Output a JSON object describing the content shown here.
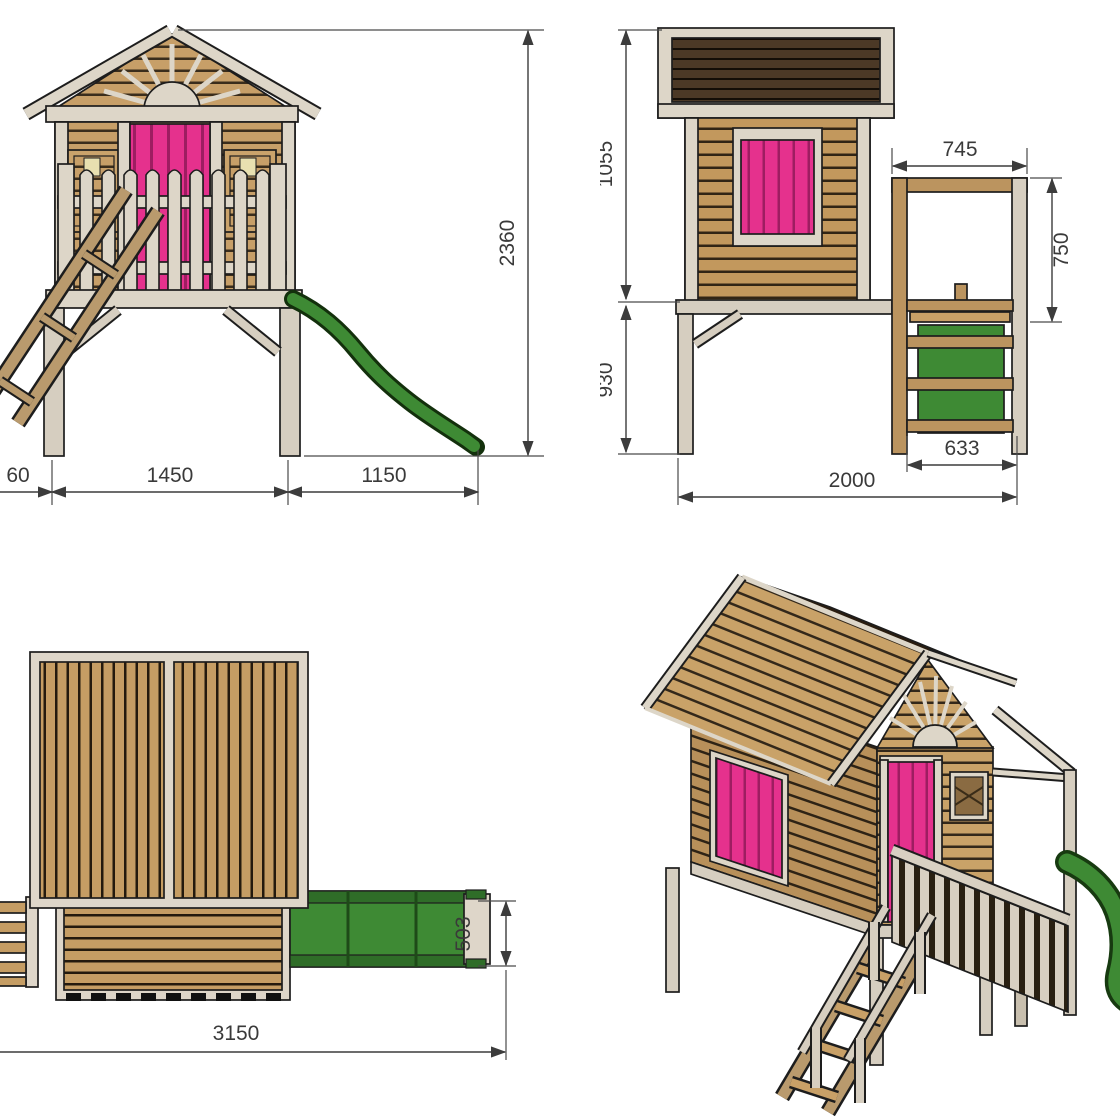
{
  "drawing": {
    "front": {
      "dims": {
        "total_height": "2360",
        "ladder_offset": "60",
        "frame_width": "1450",
        "slide_length": "1150"
      }
    },
    "side": {
      "dims": {
        "upper_height": "1055",
        "platform_height": "930",
        "porch_width": "745",
        "railing_height": "750",
        "ladder_depth": "633",
        "total_depth": "2000"
      }
    },
    "plan": {
      "dims": {
        "total_length": "3150",
        "slide_width": "503"
      }
    },
    "colors": {
      "wood_tan": "#c59d64",
      "trim_cream": "#ddd6c8",
      "roof_dark": "#2a1d10",
      "accent_pink": "#e5318d",
      "slide_green": "#3e8a34",
      "dimension_ink": "#3c3c3c"
    }
  }
}
